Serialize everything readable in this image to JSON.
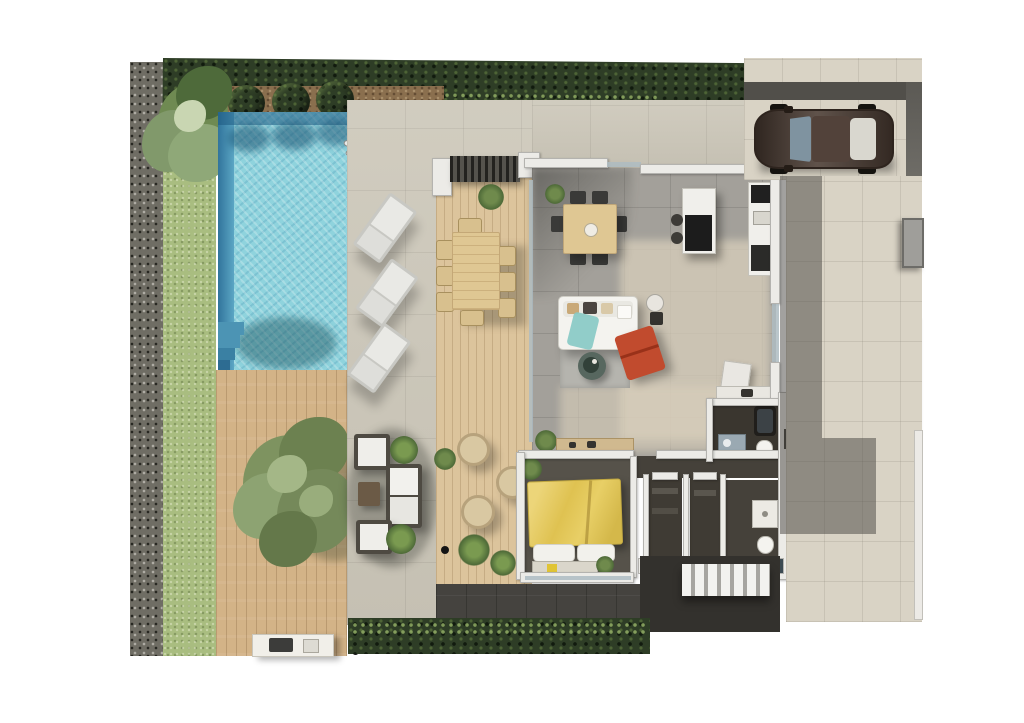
{
  "meta": {
    "title": "Villa ground-floor plan — photorealistic top-down 3D render",
    "view": "top-down",
    "canvas": {
      "width": 1024,
      "height": 723,
      "background": "#ffffff"
    }
  },
  "palette": {
    "background": "#ffffff",
    "hedge": "#2e3d26",
    "lawn": "#a9bd80",
    "gravel": "#6f6d64",
    "soil": "#8a6f4e",
    "pool_water": "#8fd3dd",
    "pool_deep": "#31749c",
    "pool_step": "#4c94b4",
    "deck_wood": "#d3b387",
    "terrace_wood": "#dcc49c",
    "stone": "#cdc8ba",
    "paving": "#d9d3c5",
    "paving_band_dark": "#514f4a",
    "asphalt_dark": "#45433f",
    "stairs_dark": "#33312d",
    "wall": "#ecebe7",
    "wall_cap": "#b4b3af",
    "tile_interior": "#a3a09a",
    "bedroom_floor": "#56524a",
    "bath_floor": "#3a362f",
    "closet_floor": "#3f3b34",
    "bed_yellow": "#e2c75f",
    "chair_red": "#c14b2e",
    "sofa_white": "#f4f3ef",
    "throw_teal": "#86c9c4",
    "rug": "#b5b4ae",
    "table_wood": "#dfc793",
    "island_white": "#f0efeb",
    "cooktop_black": "#1c1c1c",
    "car_body": "#4a3b32",
    "car_glass": "#7f93a0",
    "car_rear_glass": "#d9d7cf",
    "elevator_cab": "#96968f",
    "elevator_frame": "#d7d6d2",
    "shaft_dark": "#262421",
    "tree_green": "#7e9360",
    "plant_green": "#5d7a45",
    "wicker": "#d9c8a2",
    "lounger": "#e9e9e5",
    "bbq_white": "#f1efe9",
    "exterior_stairs_white": "#f2f2ef"
  },
  "scene": {
    "type": "architectural-floorplan-render",
    "areas": [
      {
        "id": "gravel-border",
        "label": "Gravel planting border (left edge)"
      },
      {
        "id": "lawn-strip",
        "label": "Lawn strip along pool"
      },
      {
        "id": "top-hedge",
        "label": "Dark hedge along top boundary"
      },
      {
        "id": "palm-tree",
        "label": "Palm tree, top-left corner"
      },
      {
        "id": "round-bushes",
        "label": "Three round bushes above pool"
      },
      {
        "id": "pool",
        "label": "Rectangular swimming pool with corner steps and ladder"
      },
      {
        "id": "wood-deck",
        "label": "Wooden deck with large tree and BBQ counter"
      },
      {
        "id": "stone-terrace",
        "label": "Stone paved terrace with three sun loungers and lounge set"
      },
      {
        "id": "wood-terrace",
        "label": "Covered wooden terrace with 8-seat dining table and wicker chairs"
      },
      {
        "id": "living-area",
        "label": "Open-plan living room: sofa, red lounge chair, rug, round table"
      },
      {
        "id": "dining-area",
        "label": "Indoor wooden dining table with chairs"
      },
      {
        "id": "kitchen",
        "label": "Kitchen with island, stools and wall counter"
      },
      {
        "id": "bedroom",
        "label": "Bedroom with yellow double bed"
      },
      {
        "id": "closets",
        "label": "Two walk-in closet rooms"
      },
      {
        "id": "bathroom",
        "label": "Bathroom with tub, sink and WC"
      },
      {
        "id": "shower-room",
        "label": "Shower room with WC"
      },
      {
        "id": "elevator-core",
        "label": "Elevator and internal staircase core"
      },
      {
        "id": "driveway",
        "label": "Driveway with parked dark sedan"
      },
      {
        "id": "right-paving",
        "label": "Side paved yard with utility box"
      },
      {
        "id": "exterior-stairs",
        "label": "External white staircase, bottom right"
      },
      {
        "id": "bottom-hedge",
        "label": "Hedge along bottom boundary"
      }
    ]
  }
}
